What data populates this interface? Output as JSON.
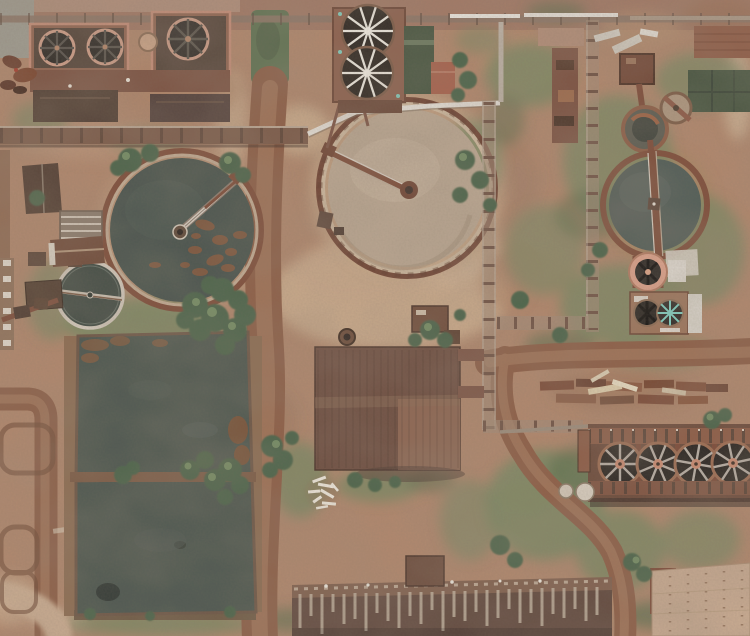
{
  "scene": {
    "description": "Aerial top-down drone photograph of a weathered industrial water-treatment plant: circular clarifier tanks, cooling-tower fan decks, rectangular settling ponds, pipe racks, rusted warehouse roofs, dirt roads and scrub vegetation",
    "type": "aerial-photograph",
    "features": [
      "west cooling-tower deck with three axial fans",
      "north cooling tower with two white-bladed fans",
      "central clarifier with tan water and rotating bridge",
      "west clarifier with dark green water and floating scum",
      "small west thickener with white bridge",
      "east clarifier with slate-green water",
      "east thickener, square tank and auxiliary fan units",
      "twin-fan cooler with teal impeller",
      "four-fan cooling train at southeast",
      "two rectangular settling ponds with trees on berms",
      "long rusted warehouse roof with pale streaks",
      "tan riveted warehouse roof",
      "central workshop building with corrugated roof",
      "white process pipe and rusty pipe racks",
      "red dirt roads, drying beds, scattered lumber and debris"
    ]
  },
  "palette": {
    "ground": "#ad8469",
    "ground_light": "#c9ac8d",
    "ground_dark": "#9a7058",
    "road": "#8a5c44",
    "road_light": "#aa8062",
    "grass": "#75855f",
    "grass_dark": "#5a6c4b",
    "tree": "#4a6247",
    "tree_light": "#7b9468",
    "water_pond": "#4b554d",
    "water_clarifier_west": "#46514a",
    "water_clarifier_east": "#4e5a54",
    "water_tan": "#b7a48e",
    "basin": "#46543f",
    "rust": "#8a5a42",
    "rust_dark": "#6b4433",
    "rust_light": "#c08a74",
    "salmon": "#d99e87",
    "rust_deck": "#8a5f4c",
    "steel_dark": "#302b25",
    "metal_white": "#ded9d0",
    "panel": "#d5d0c6",
    "teal": "#7ccfc0",
    "roof_dark": "#5f473c",
    "roof_tan": "#c4a78d",
    "roof_streak": "#c7b9a6",
    "concrete": "#cfc6b8",
    "fan_spoke": "#b5ada3",
    "hub": "#c9886e",
    "scum": "#7e563c"
  }
}
